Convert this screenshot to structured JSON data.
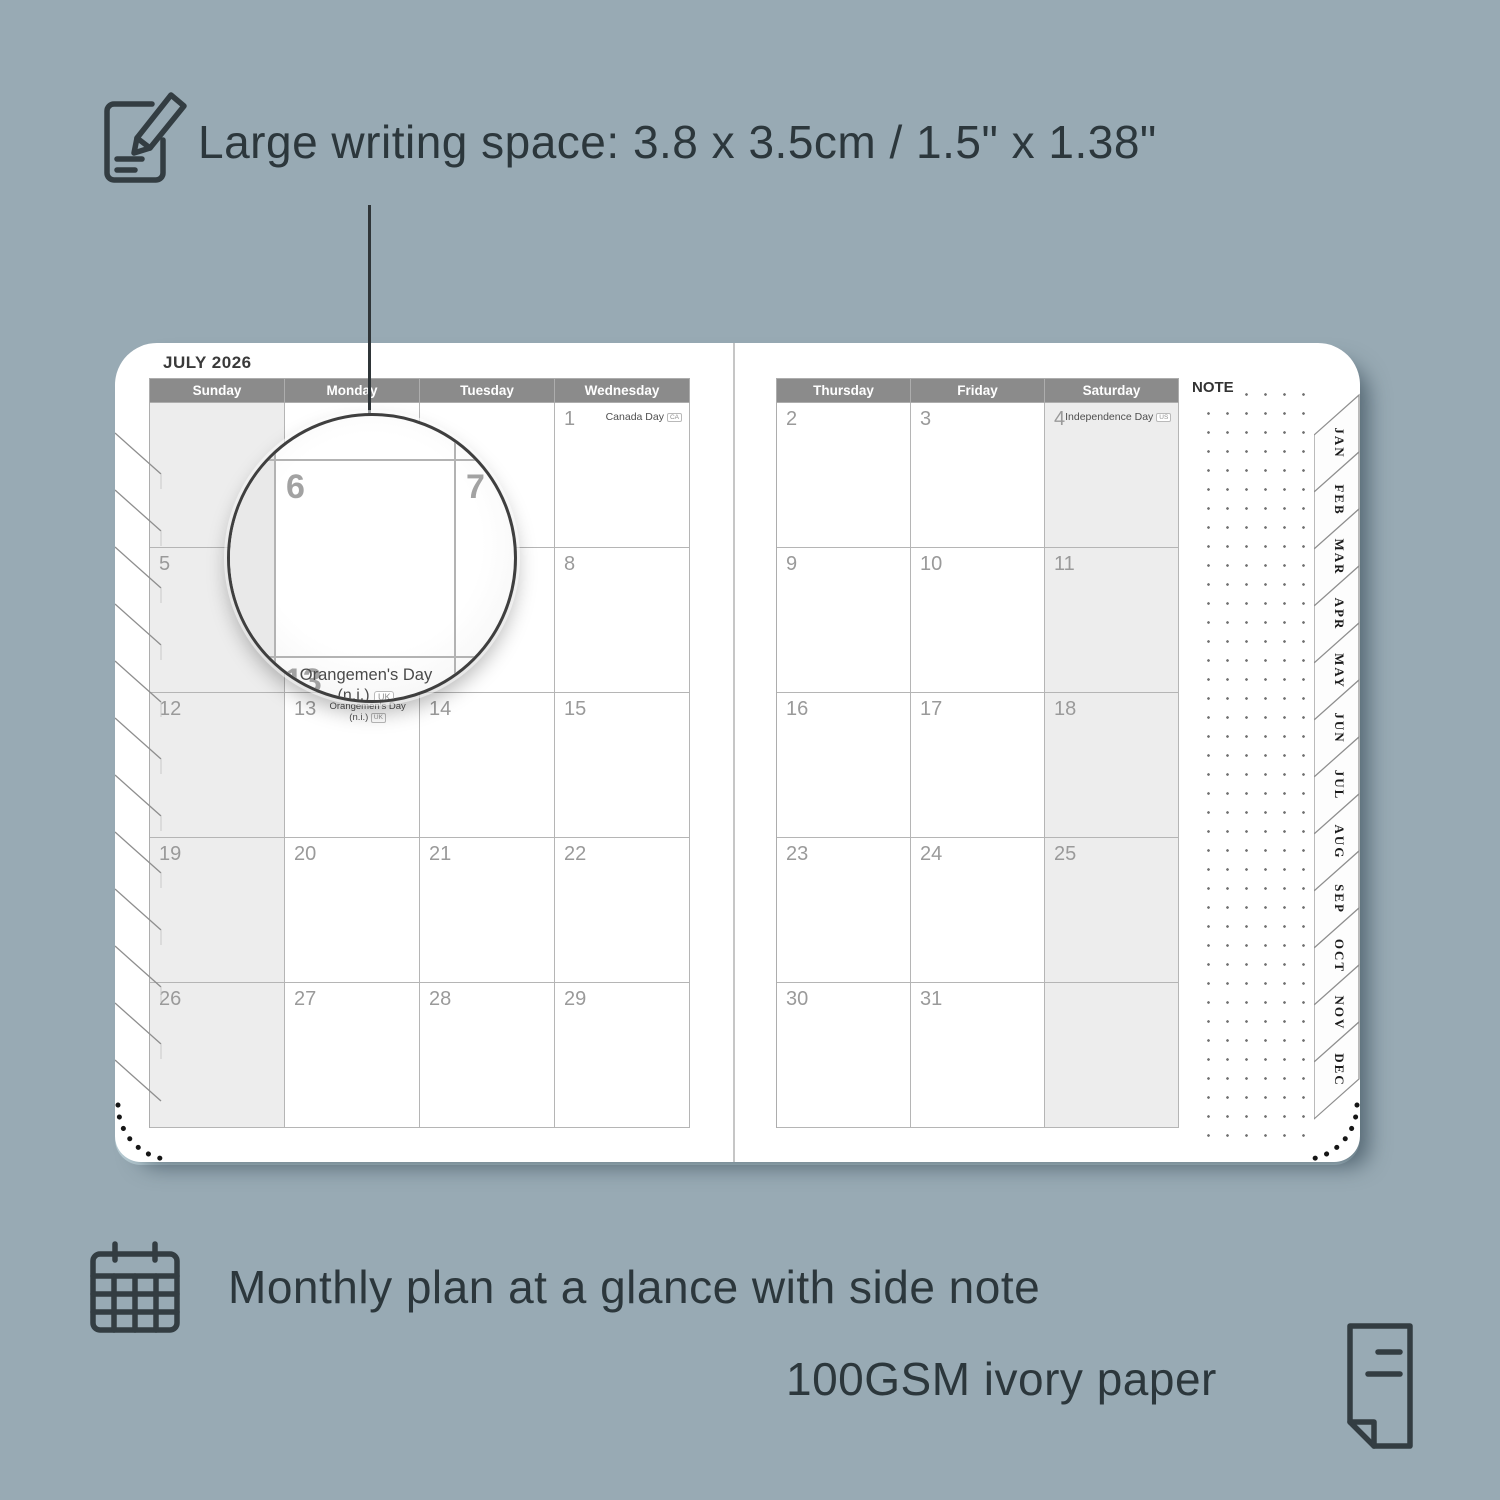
{
  "colors": {
    "background": "#98aab4",
    "header_bar": "#8b8b8b",
    "shaded_cell": "#ededed",
    "annotation_text": "#2c373c",
    "page_white": "#ffffff"
  },
  "annotations": {
    "top": {
      "icon": "notepad-pencil-icon",
      "text": "Large writing space: 3.8 x 3.5cm / 1.5\" x 1.38\""
    },
    "bottom_left": {
      "icon": "calendar-grid-icon",
      "text": "Monthly plan at a glance with side note"
    },
    "bottom_right": {
      "icon": "paper-folded-corner-icon",
      "text": "100GSM ivory paper"
    }
  },
  "planner": {
    "title": "JULY 2026",
    "note_label": "NOTE",
    "left_page": {
      "day_headers": [
        "Sunday",
        "Monday",
        "Tuesday",
        "Wednesday"
      ],
      "shaded_column": 0,
      "weeks": [
        [
          {
            "day": ""
          },
          {
            "day": ""
          },
          {
            "day": ""
          },
          {
            "day": "1",
            "holiday": "Canada Day",
            "badge": "CA"
          }
        ],
        [
          {
            "day": "5"
          },
          {
            "day": "6"
          },
          {
            "day": "7"
          },
          {
            "day": "8"
          }
        ],
        [
          {
            "day": "12"
          },
          {
            "day": "13",
            "holiday": "Orangemen's Day",
            "holiday_note": "(n.i.)",
            "badge": "UK",
            "layout": "stacked"
          },
          {
            "day": "14"
          },
          {
            "day": "15"
          }
        ],
        [
          {
            "day": "19"
          },
          {
            "day": "20"
          },
          {
            "day": "21"
          },
          {
            "day": "22"
          }
        ],
        [
          {
            "day": "26"
          },
          {
            "day": "27"
          },
          {
            "day": "28"
          },
          {
            "day": "29"
          }
        ]
      ]
    },
    "right_page": {
      "day_headers": [
        "Thursday",
        "Friday",
        "Saturday"
      ],
      "shaded_column": 2,
      "weeks": [
        [
          {
            "day": "2"
          },
          {
            "day": "3"
          },
          {
            "day": "4",
            "holiday": "Independence Day",
            "badge": "US"
          }
        ],
        [
          {
            "day": "9"
          },
          {
            "day": "10"
          },
          {
            "day": "11"
          }
        ],
        [
          {
            "day": "16"
          },
          {
            "day": "17"
          },
          {
            "day": "18"
          }
        ],
        [
          {
            "day": "23"
          },
          {
            "day": "24"
          },
          {
            "day": "25"
          }
        ],
        [
          {
            "day": "30"
          },
          {
            "day": "31"
          },
          {
            "day": ""
          }
        ]
      ]
    },
    "month_tabs": [
      "JAN",
      "FEB",
      "MAR",
      "APR",
      "MAY",
      "JUN",
      "JUL",
      "AUG",
      "SEP",
      "OCT",
      "NOV",
      "DEC"
    ],
    "magnifier": {
      "day_a": "6",
      "day_b": "7",
      "day_c": "13",
      "holiday_line1": "Orangemen's Day",
      "holiday_note": "(n.i.)",
      "badge": "UK"
    }
  }
}
